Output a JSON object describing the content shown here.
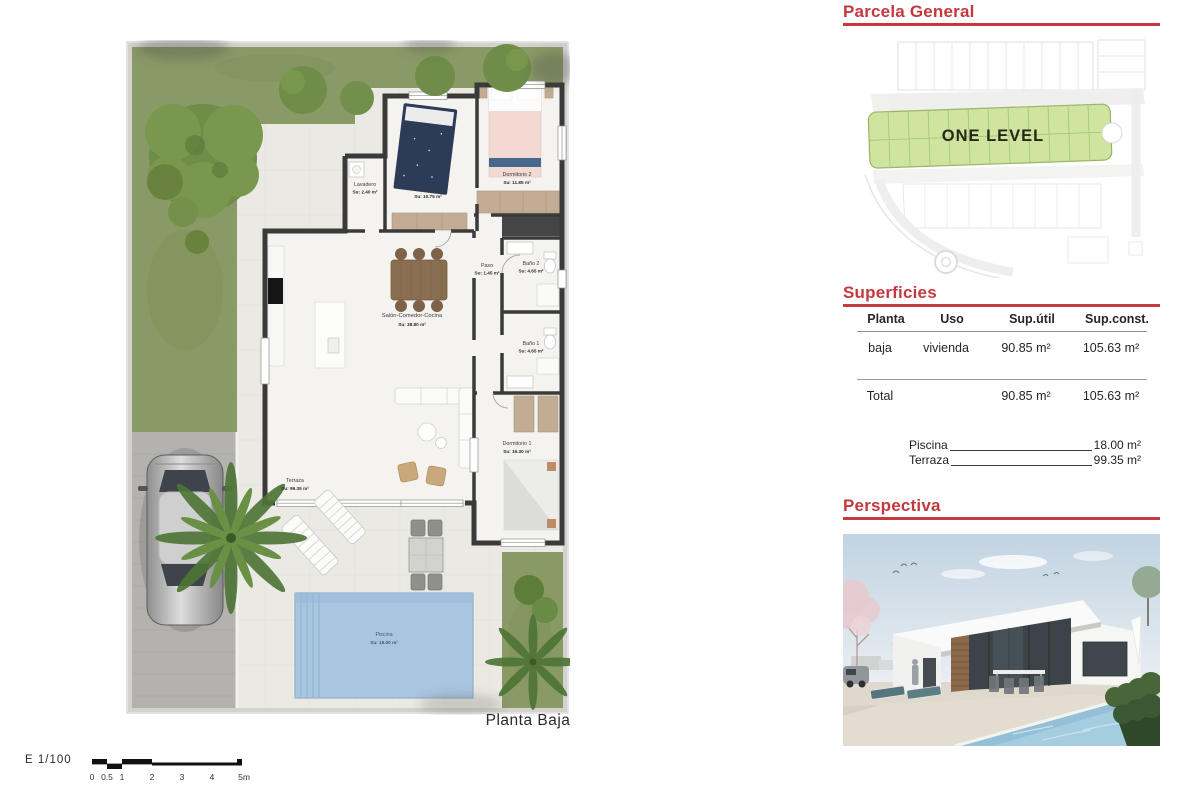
{
  "plan": {
    "caption": "Planta Baja",
    "rooms": [
      {
        "name": "Lavadero",
        "area": "Su: 2.40 m²"
      },
      {
        "name": "Dormitorio 3",
        "area": "Su: 10.75 m²"
      },
      {
        "name": "Dormitorio 2",
        "area": "Su: 11.85 m²"
      },
      {
        "name": "Paso",
        "area": "Su: 1.45 m²"
      },
      {
        "name": "Baño 2",
        "area": "Su: 4.65 m²"
      },
      {
        "name": "Salón-Comedor-Cocina",
        "area": "Su: 38.80 m²"
      },
      {
        "name": "Baño 1",
        "area": "Su: 4.65 m²"
      },
      {
        "name": "Dormitorio 1",
        "area": "Su: 16.30 m²"
      },
      {
        "name": "Terraza",
        "area": "Su: 99.35 m²"
      },
      {
        "name": "Piscina",
        "area": "Su: 18.00 m²"
      }
    ],
    "scale_bar": {
      "label": "E 1/100",
      "ticks": [
        "0",
        "0.5",
        "1",
        "2",
        "3",
        "4",
        "5m"
      ]
    }
  },
  "parcela": {
    "title": "Parcela General",
    "plot_label": "ONE LEVEL"
  },
  "superficies": {
    "title": "Superficies",
    "columns": [
      "Planta",
      "Uso",
      "Sup.útil",
      "Sup.const."
    ],
    "rows": [
      {
        "planta": "baja",
        "uso": "vivienda",
        "sup_util": "90.85 m²",
        "sup_const": "105.63 m²"
      }
    ],
    "total": {
      "label": "Total",
      "sup_util": "90.85 m²",
      "sup_const": "105.63 m²"
    },
    "extras": [
      {
        "label": "Piscina",
        "value": "18.00 m²"
      },
      {
        "label": "Terraza",
        "value": "99.35 m²"
      }
    ]
  },
  "perspectiva": {
    "title": "Perspectiva"
  },
  "colors": {
    "accent_red": "#c5393e",
    "grass_green": "#8a9a66",
    "pool_blue": "#a9c6e1",
    "wall_dark": "#3a3a3a",
    "parcela_green": "#cfe49e"
  }
}
